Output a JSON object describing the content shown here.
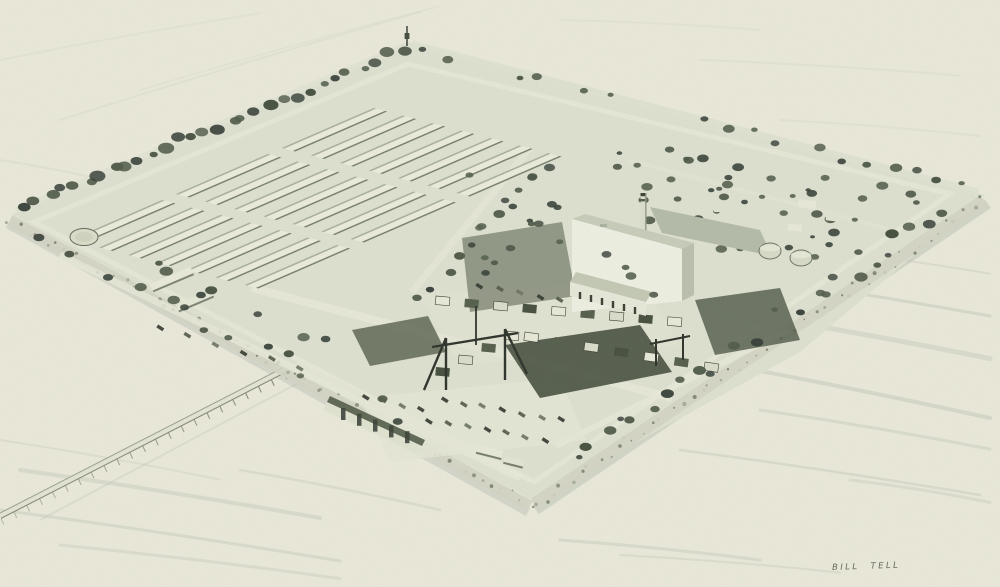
{
  "artwork": {
    "description": "Black-and-white halftone artist's aerial rendering of a square man-made industrial island in open water: rows of long warehouse buildings on the left, a tall white plant building with smokestack and two storage tanks at center-right, an orchard of scattered trees on the right, a switchyard with gantry cranes, dark lawns, parking lots with cars, a tree-lined perimeter with rocky riprap shores, a wharf, and a long causeway trestle running to the lower left.",
    "signature": "BILL TELL"
  },
  "palette": {
    "paper": "#e8e7d8",
    "water_shadow": "#aeb9ab",
    "island": "#dcdfce",
    "foliage_dark": "#39423a",
    "field_dark": "#4d5745",
    "building_light": "#eceee0",
    "building_shadow": "#b9bfac",
    "rock_light": "#d1d3c2",
    "ink_dark": "#31372c",
    "signature_ink": "#666b5e"
  }
}
